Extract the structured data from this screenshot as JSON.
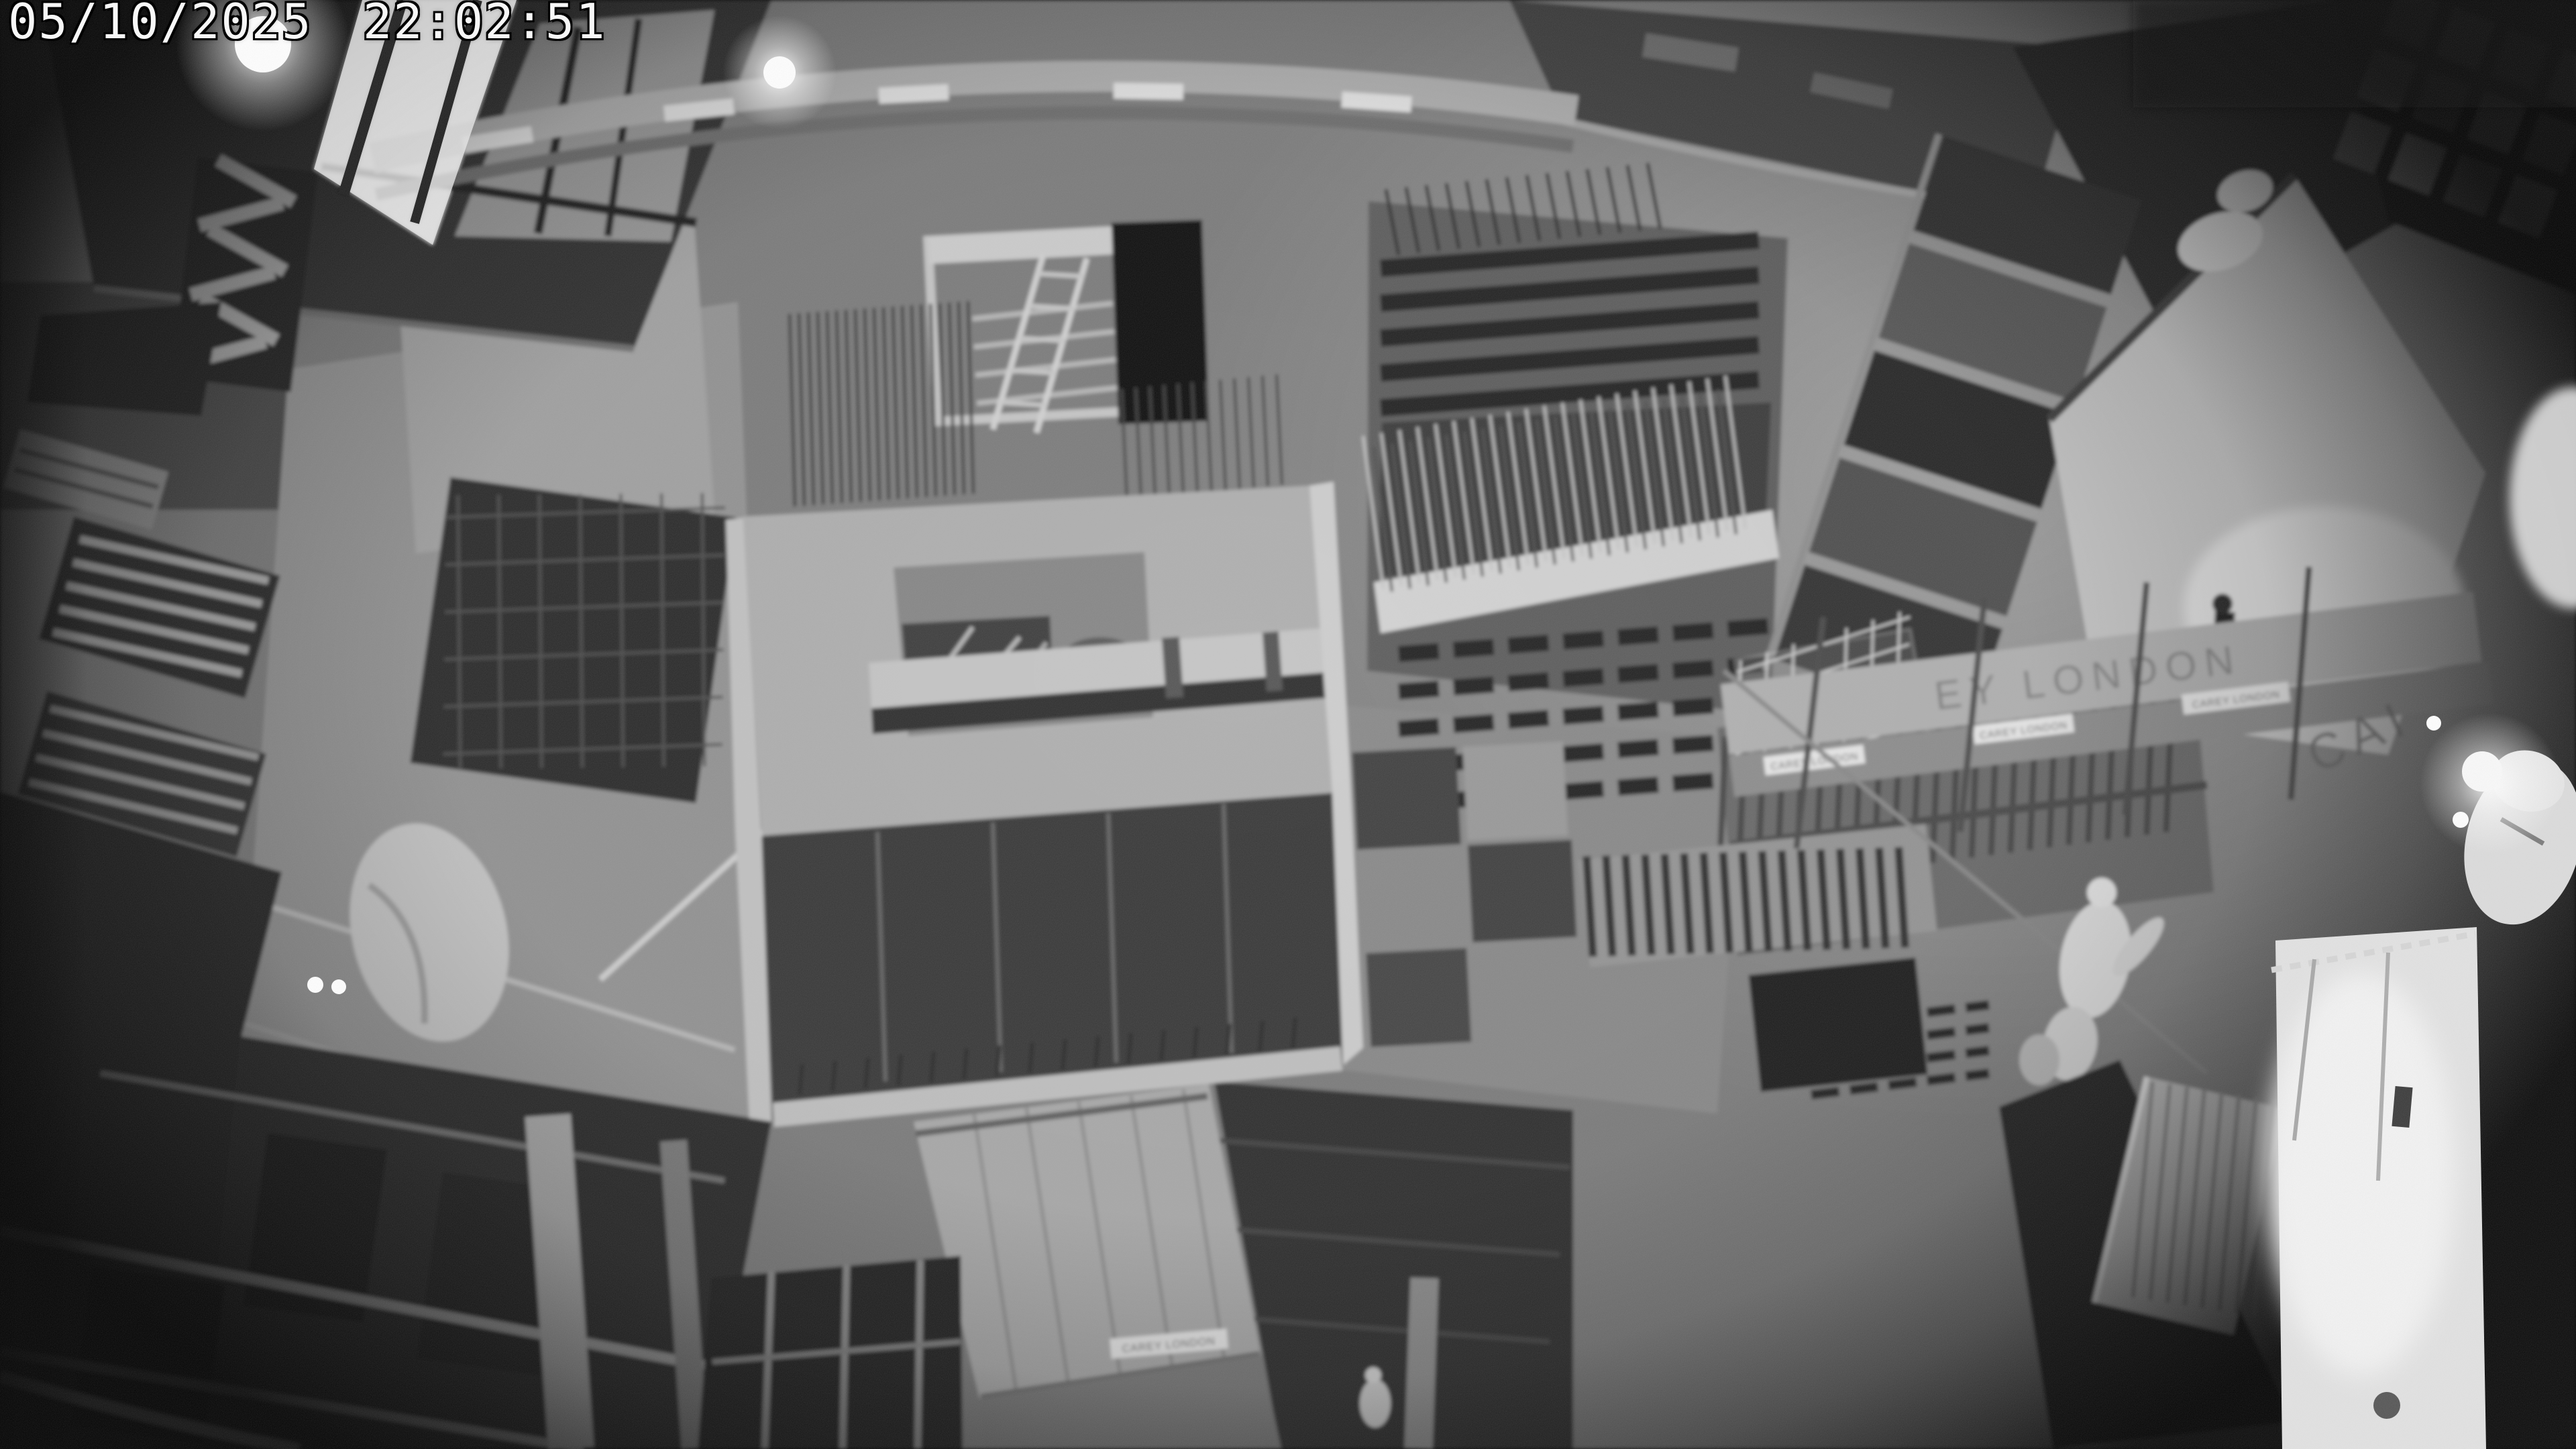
{
  "overlay": {
    "timestamp": "05/10/2025 22:02:51"
  },
  "photo": {
    "banners": {
      "large_fragment_left": "EY LONDON",
      "large_fragment_right": "CAI",
      "tag": "CAREY LONDON"
    },
    "palette": {
      "night_base": "#7d7d7d",
      "concrete_light": "#b0b0b0",
      "slab_bright": "#c9c9c9",
      "plywood_dark": "#373737",
      "deep_shadow": "#161616",
      "street_bright": "#e2e2e2",
      "osd_text": "#f7f7f7",
      "osd_outline": "#000000"
    }
  }
}
